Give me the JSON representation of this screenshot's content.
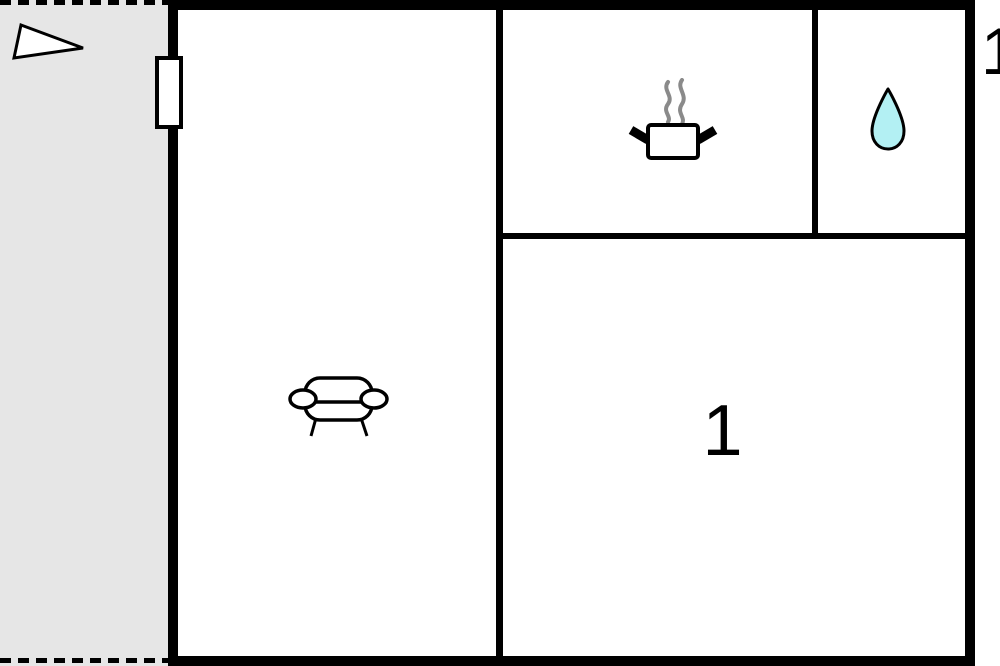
{
  "labels": {
    "bedroom_number": "1",
    "exterior_number": "1"
  },
  "icons": {
    "north_arrow": "triangle-pointer",
    "kitchen": "cooking-pot-with-steam",
    "bathroom": "water-drop",
    "living_room": "sofa",
    "entrance": "door-window-marker"
  },
  "colors": {
    "wall": "#000000",
    "terrace_fill": "#e6e6e6",
    "drop_fill": "#b3f0f3",
    "steam": "#8a8a8a",
    "background": "#ffffff"
  }
}
